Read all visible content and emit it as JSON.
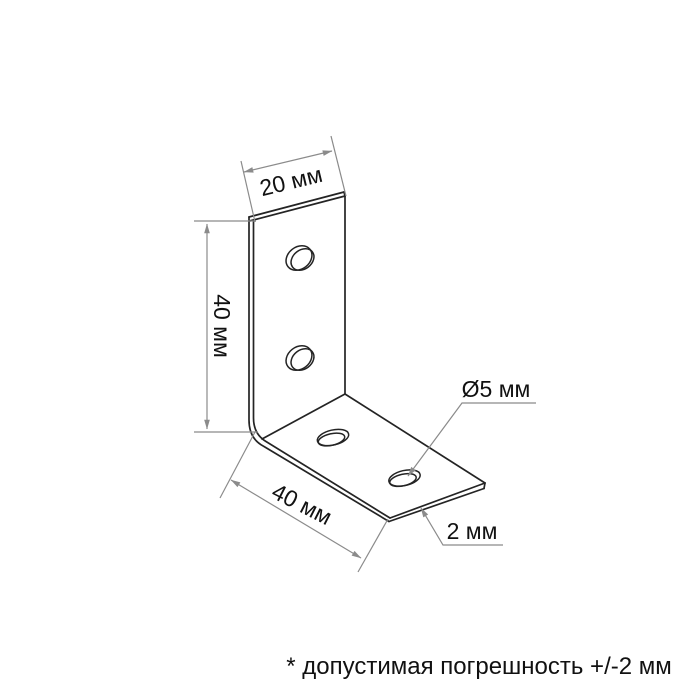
{
  "diagram": {
    "title": "corner-bracket-technical-drawing",
    "labels": {
      "top_width": "20 мм",
      "vertical_leg": "40 мм",
      "base_length": "40 мм",
      "hole_diameter": "Ø5 мм",
      "thickness": "2 мм"
    },
    "footnote": "* допустимая погрешность +/-2 мм",
    "colors": {
      "outline": "#242424",
      "dimension_lines": "#8b8b8b",
      "text": "#111111",
      "background": "#ffffff"
    }
  }
}
